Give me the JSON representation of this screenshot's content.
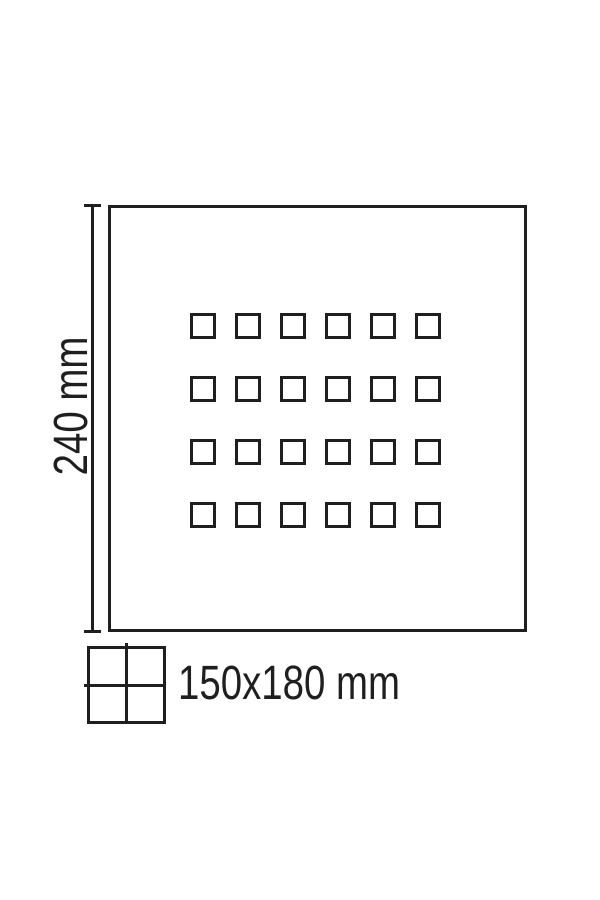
{
  "diagram": {
    "title": "perforated-panel-dimension-drawing",
    "height_label": "240 mm",
    "tile_size_label": "150x180 mm",
    "grid": {
      "rows": 4,
      "columns": 6
    },
    "colors": {
      "line": "#1f1f1f",
      "background": "#ffffff"
    }
  }
}
